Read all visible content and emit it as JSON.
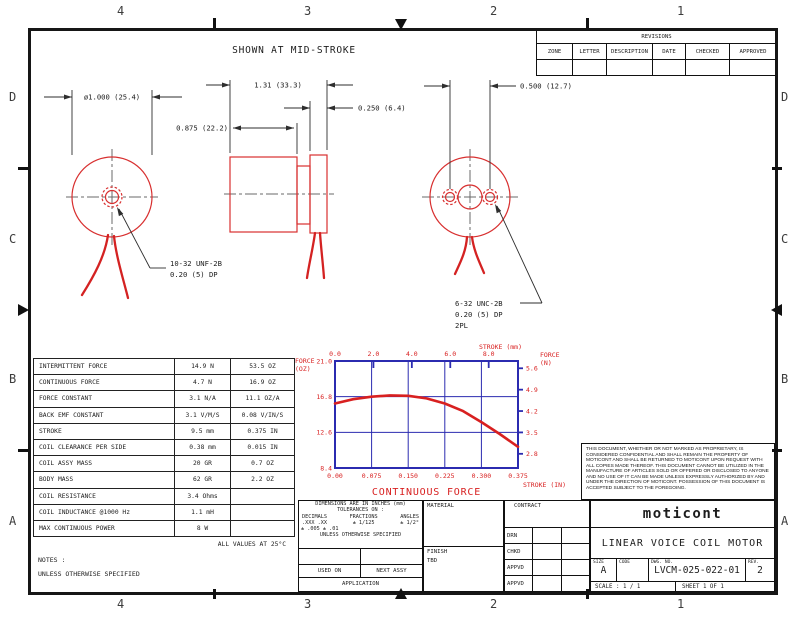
{
  "zones": {
    "top": [
      "4",
      "3",
      "2",
      "1"
    ],
    "bottom": [
      "4",
      "3",
      "2",
      "1"
    ],
    "left": [
      "D",
      "C",
      "B",
      "A"
    ],
    "right": [
      "D",
      "C",
      "B",
      "A"
    ]
  },
  "revisions": {
    "title": "REVISIONS",
    "columns": [
      "ZONE",
      "LETTER",
      "DESCRIPTION",
      "DATE",
      "CHECKED",
      "APPROVED"
    ]
  },
  "drawing": {
    "caption": "SHOWN AT MID-STROKE",
    "dim_diameter": "ø1.000 (25.4)",
    "dim_length": "1.31 (33.3)",
    "dim_body": "0.875 (22.2)",
    "dim_plate": "0.250 (6.4)",
    "dim_holes": "0.500 (12.7)",
    "thread_left_1": "10-32 UNF-2B",
    "thread_left_2": "0.20 (5) DP",
    "thread_right_1": "6-32 UNC-2B",
    "thread_right_2": "0.20 (5) DP",
    "thread_right_3": "2PL",
    "part_color": "#d83030",
    "centerline_color": "#6a6a6a"
  },
  "spec_table": {
    "rows": [
      [
        "INTERMITTENT FORCE",
        "14.9 N",
        "53.5 OZ"
      ],
      [
        "CONTINUOUS FORCE",
        "4.7 N",
        "16.9 OZ"
      ],
      [
        "FORCE CONSTANT",
        "3.1 N/A",
        "11.1 OZ/A"
      ],
      [
        "BACK EMF CONSTANT",
        "3.1 V/M/S",
        "0.08 V/IN/S"
      ],
      [
        "STROKE",
        "9.5 mm",
        "0.375 IN"
      ],
      [
        "COIL CLEARANCE PER SIDE",
        "0.38 mm",
        "0.015 IN"
      ],
      [
        "COIL ASSY MASS",
        "20 GR",
        "0.7 OZ"
      ],
      [
        "BODY MASS",
        "62 GR",
        "2.2 OZ"
      ],
      [
        "COIL RESISTANCE",
        "3.4 Ohms",
        ""
      ],
      [
        "COIL INDUCTANCE @1000 Hz",
        "1.1 mH",
        ""
      ],
      [
        "MAX CONTINUOUS POWER",
        "8 W",
        ""
      ]
    ],
    "footnote": "ALL VALUES AT 25°C"
  },
  "chart_data": {
    "type": "line",
    "title": "CONTINUOUS FORCE",
    "top_axis": {
      "label": "STROKE (mm)",
      "ticks": [
        0.0,
        2.0,
        4.0,
        6.0,
        8.0
      ],
      "max_mm": 9.525
    },
    "bottom_axis": {
      "label": "STROKE (IN)",
      "ticks": [
        "0.00",
        "0.075",
        "0.150",
        "0.225",
        "0.300",
        "0.375"
      ],
      "range": [
        0,
        0.375
      ]
    },
    "left_axis": {
      "label_1": "FORCE",
      "label_2": "(OZ)",
      "ticks": [
        21.0,
        16.8,
        12.6,
        8.4
      ],
      "range": [
        8.4,
        21.0
      ]
    },
    "right_axis": {
      "label_1": "FORCE",
      "label_2": "(N)",
      "ticks": [
        5.6,
        4.9,
        4.2,
        3.5,
        2.8
      ],
      "oz_per_newton": 3.5969
    },
    "series": [
      {
        "name": "CONTINUOUS FORCE",
        "x_in": [
          0,
          0.0375,
          0.075,
          0.1125,
          0.15,
          0.1875,
          0.225,
          0.2625,
          0.3,
          0.3375,
          0.375
        ],
        "y_oz": [
          16.0,
          16.5,
          16.8,
          16.95,
          16.9,
          16.6,
          16.0,
          15.1,
          13.8,
          12.4,
          10.9
        ]
      }
    ],
    "grid": true,
    "legend_position": "none",
    "frame_color": "#2b2bb0",
    "curve_color": "#d82020",
    "label_color": "#d82020"
  },
  "notes": {
    "line1": "NOTES :",
    "line2": "UNLESS OTHERWISE SPECIFIED"
  },
  "tolerance_block": {
    "line1": "DIMENSIONS ARE IN INCHES (mm)",
    "line2": "TOLERANCES ON :",
    "col_headers": [
      "DECIMALS",
      "FRACTIONS",
      "ANGLES"
    ],
    "decimals_1": ".XXX  .XX",
    "decimals_2": "± .005 ± .01",
    "fractions": "±  1/125",
    "angles": "± 1/2°",
    "line6": "UNLESS OTHERWISE SPECIFIED",
    "used_on": "USED ON",
    "next_assy": "NEXT ASSY",
    "application": "APPLICATION"
  },
  "material_block": {
    "material_label": "MATERIAL",
    "finish_label": "FINISH",
    "finish_value": "TBD"
  },
  "contract_block": {
    "label": "CONTRACT",
    "rows": [
      "DRN",
      "CHKD",
      "APPVD",
      "APPVD"
    ]
  },
  "title_block": {
    "brand": "moticont",
    "title": "LINEAR VOICE COIL MOTOR",
    "size_label": "SIZE",
    "size": "A",
    "code_label": "CODE",
    "dwg_label": "DWG. NO.",
    "dwg_no": "LVCM-025-022-01",
    "rev_label": "REV.",
    "rev": "2",
    "scale_label": "SCALE :",
    "scale": "1 / 1",
    "sheet": "SHEET  1  OF  1"
  },
  "disclaimer": "THIS DOCUMENT, WHETHER OR NOT MARKED AS PROPRIETARY, IS CONSIDERED CONFIDENTIAL AND SHALL REMAIN THE PROPERTY OF MOTICONT AND SHALL BE RETURNED TO MOTICONT UPON REQUEST WITH ALL COPIES MADE THEREOF. THIS DOCUMENT CANNOT BE UTILIZED IN THE MANUFACTURE OF ARTICLES SOLD OR OFFERED OR DISCLOSED TO ANYONE AND NO USE OF IT CAN BE MADE UNLESS EXPRESSLY AUTHORIZED BY AND UNDER THE DIRECTION OF MOTICONT. POSSESSION OF THIS DOCUMENT IS ACCEPTED SUBJECT TO THE FOREGOING."
}
